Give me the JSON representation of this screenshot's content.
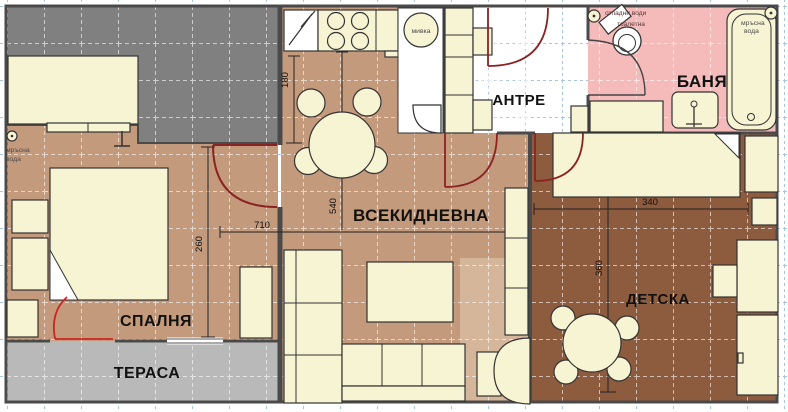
{
  "plan_title": "apartment floor plan",
  "rooms": {
    "bedroom": {
      "label": "СПАЛНЯ"
    },
    "terrace": {
      "label": "ТЕРАСА"
    },
    "living": {
      "label": "ВСЕКИДНЕВНА"
    },
    "hall": {
      "label": "АНТРЕ"
    },
    "bathroom": {
      "label": "БАНЯ"
    },
    "kids": {
      "label": "ДЕТСКА"
    }
  },
  "fixtures": {
    "kitchen_sink": "мивка"
  },
  "plumbing": {
    "bedroom_waste_1": "мръсна",
    "bedroom_waste_2": "вода",
    "bath_sewage": "отпадни води",
    "bath_toilet": "тоалетна",
    "bath_waste_1": "мръсна",
    "bath_waste_2": "вода"
  },
  "dimensions": {
    "kitchen_depth": "180",
    "living_height": "540",
    "plan_width": "710",
    "bedroom_depth": "260",
    "kids_width": "340",
    "kids_height": "360"
  },
  "colors": {
    "outside_area": "#808080",
    "terrace_floor": "#b9b9b9",
    "bedroom_floor": "#c49a7c",
    "living_floor": "#c49a7c",
    "living_floor_light": "#d6b69a",
    "kids_floor": "#8d5b3d",
    "bath_floor": "#f5baba",
    "furniture": "#f7f4d3",
    "wall": "#4a4a4a",
    "door": "#8b2323",
    "grid_blue": "#a9c6e0"
  }
}
